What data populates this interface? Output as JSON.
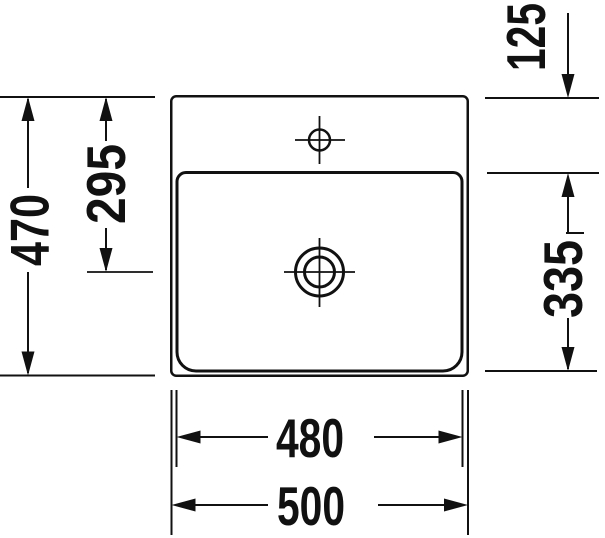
{
  "colors": {
    "background": "#ffffff",
    "line": "#111111"
  },
  "dimensions": {
    "left_outer": "470",
    "left_inner": "295",
    "right_top": "125",
    "right_bottom": "335",
    "bottom_inner": "480",
    "bottom_outer": "500"
  }
}
